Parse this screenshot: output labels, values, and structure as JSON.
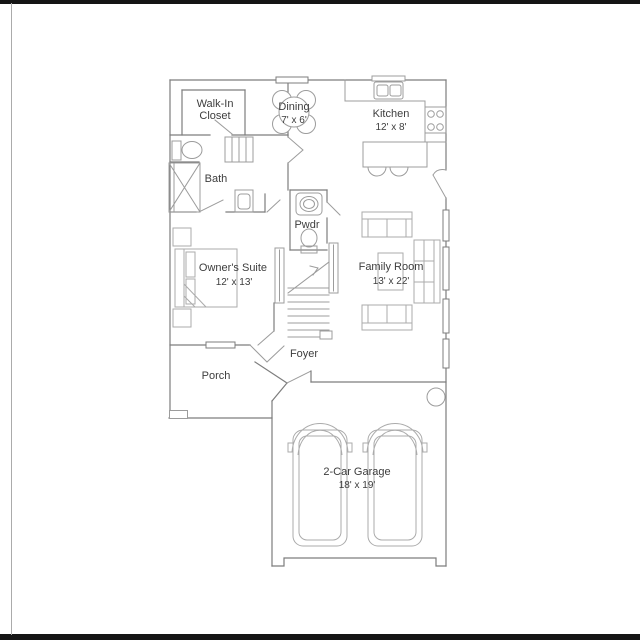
{
  "floor_plan": {
    "rooms": {
      "walk_in_closet": {
        "line1": "Walk-In",
        "line2": "Closet"
      },
      "dining": {
        "name": "Dining",
        "dims": "7' x 6'"
      },
      "kitchen": {
        "name": "Kitchen",
        "dims": "12' x 8'"
      },
      "bath": {
        "name": "Bath"
      },
      "powder": {
        "name": "Pwdr"
      },
      "owners_suite": {
        "name": "Owner's Suite",
        "dims": "12' x 13'"
      },
      "family_room": {
        "name": "Family Room",
        "dims": "13' x 22'"
      },
      "foyer": {
        "name": "Foyer"
      },
      "porch": {
        "name": "Porch"
      },
      "garage": {
        "name": "2-Car Garage",
        "dims": "18' x 19'"
      }
    },
    "colors": {
      "wall": "#7d7d7d",
      "fixture": "#9c9c9c",
      "furniture": "#ababab",
      "text": "#3d3d3d",
      "frame_bar": "#151515"
    }
  }
}
